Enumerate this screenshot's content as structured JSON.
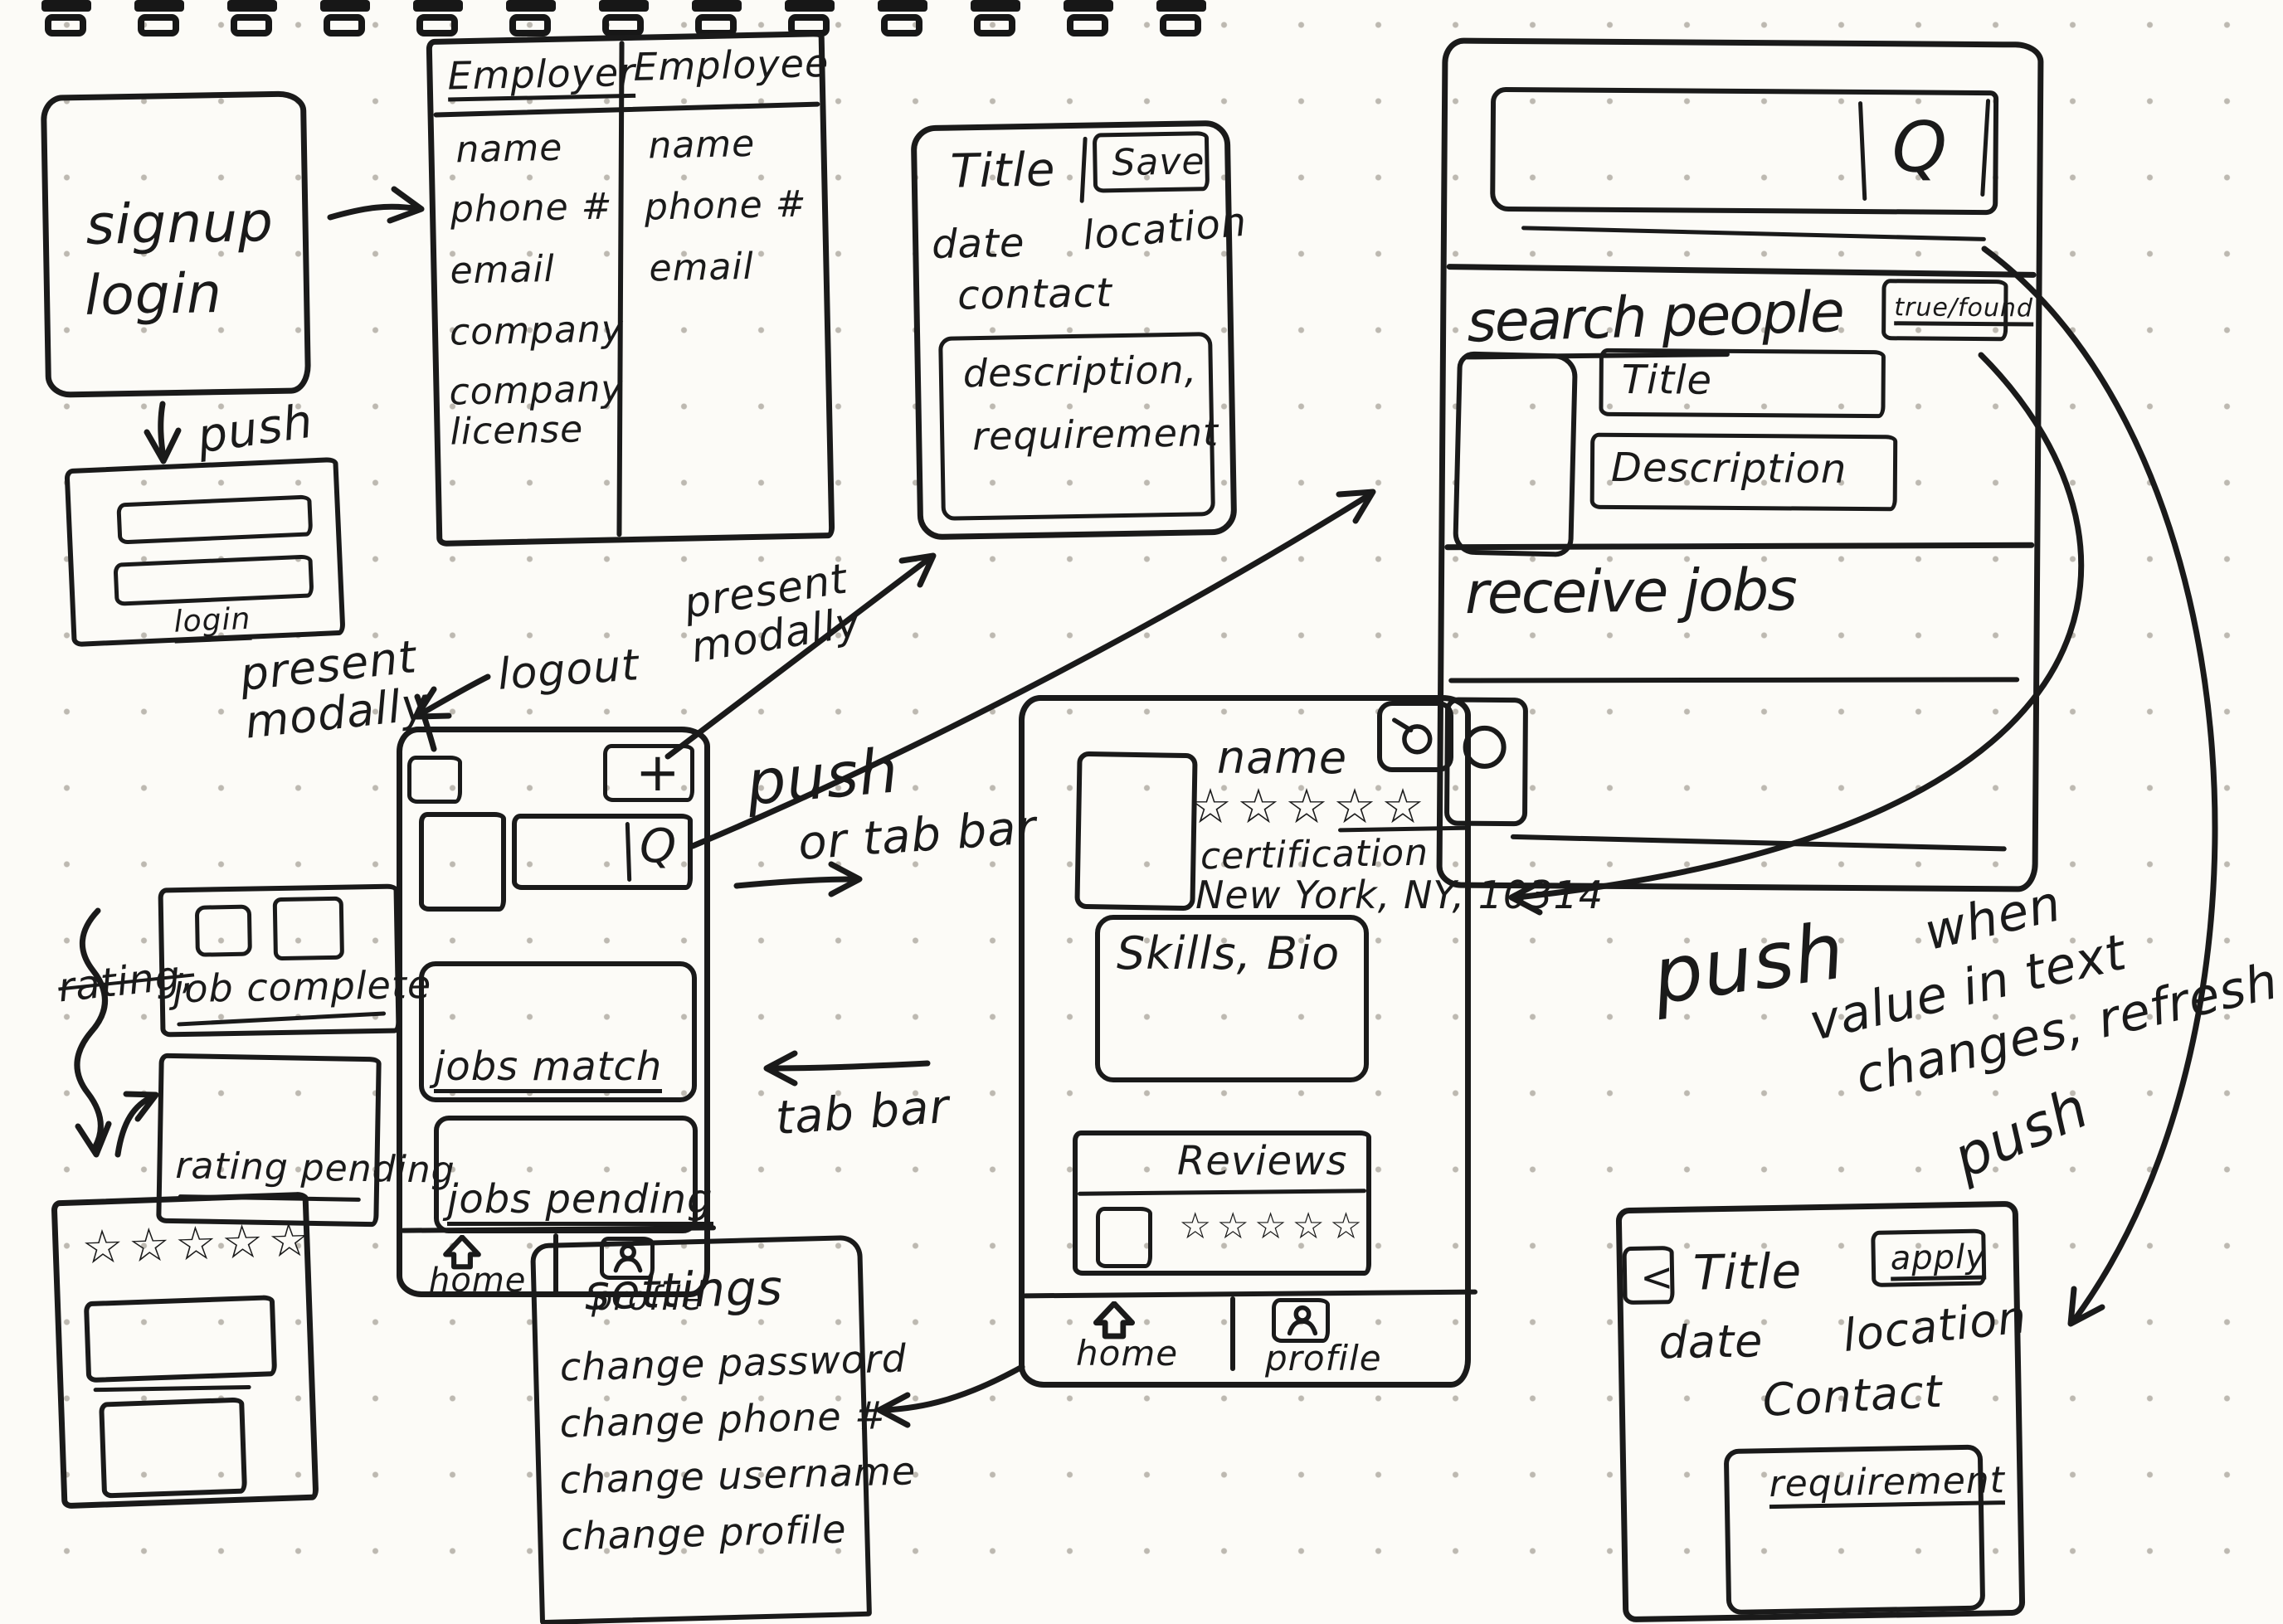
{
  "palette": {
    "ink": "#1a1a1a",
    "paper": "#fcfbf7",
    "dot": "#bdb9b1"
  },
  "icons": {
    "search": "Q",
    "add": "+",
    "back": "<",
    "home": "house-arrow",
    "profile": "person",
    "camera": "camera",
    "star": "☆"
  },
  "annotations": {
    "push_login": "push",
    "present_modally_left": "present modally",
    "logout": "logout",
    "present_modally_right": "present modally",
    "push_or_tabbar_line1": "push",
    "push_or_tabbar_line2": "or tab bar",
    "tab_bar": "tab bar",
    "push_to_profile": "push",
    "refresh_line1": "when",
    "refresh_line2": "value in text",
    "refresh_line3": "changes, refresh",
    "push_on_change": "push",
    "rating_strike": "rating,"
  },
  "auth_screen": {
    "line1": "signup",
    "line2": "login"
  },
  "login_modal": {
    "submit": "login"
  },
  "signup_table": {
    "col1": "Employer",
    "col2": "Employee",
    "employer_fields": [
      "name",
      "phone #",
      "email",
      "company",
      "company license"
    ],
    "employee_fields": [
      "name",
      "phone #",
      "email"
    ]
  },
  "job_post_modal": {
    "title": "Title",
    "save": "Save",
    "date": "date",
    "location": "location",
    "contact": "contact",
    "description": "description,",
    "requirement": "requirement"
  },
  "search_screen": {
    "search_icon": "Q",
    "heading": "search people",
    "filter_button": "true/found",
    "title_field": "Title",
    "description_field": "Description",
    "section_heading": "receive jobs"
  },
  "home_screen": {
    "add_button": "+",
    "search_icon": "Q",
    "card_jobs_match": "jobs match",
    "card_jobs_pending": "jobs pending",
    "tab_home": "home",
    "tab_profile": "profile"
  },
  "profile_screen": {
    "name": "name",
    "rating_stars": "☆☆☆☆☆",
    "certification": "certification",
    "location": "New York, NY, 10314",
    "skills_bio": "Skills, Bio",
    "reviews_title": "Reviews",
    "review_stars": "☆☆☆☆☆",
    "tab_home": "home",
    "tab_profile": "profile"
  },
  "job_complete_card": {
    "label": "job complete"
  },
  "rating_pending_card": {
    "label": "rating pending"
  },
  "rating_screen": {
    "stars": "☆☆☆☆☆"
  },
  "settings_screen": {
    "title": "settings",
    "items": [
      "change password",
      "change phone #",
      "change username",
      "change profile"
    ]
  },
  "job_detail_screen": {
    "back": "<",
    "title": "Title",
    "apply": "apply",
    "date": "date",
    "location": "location",
    "contact": "Contact",
    "requirement": "requirement"
  }
}
